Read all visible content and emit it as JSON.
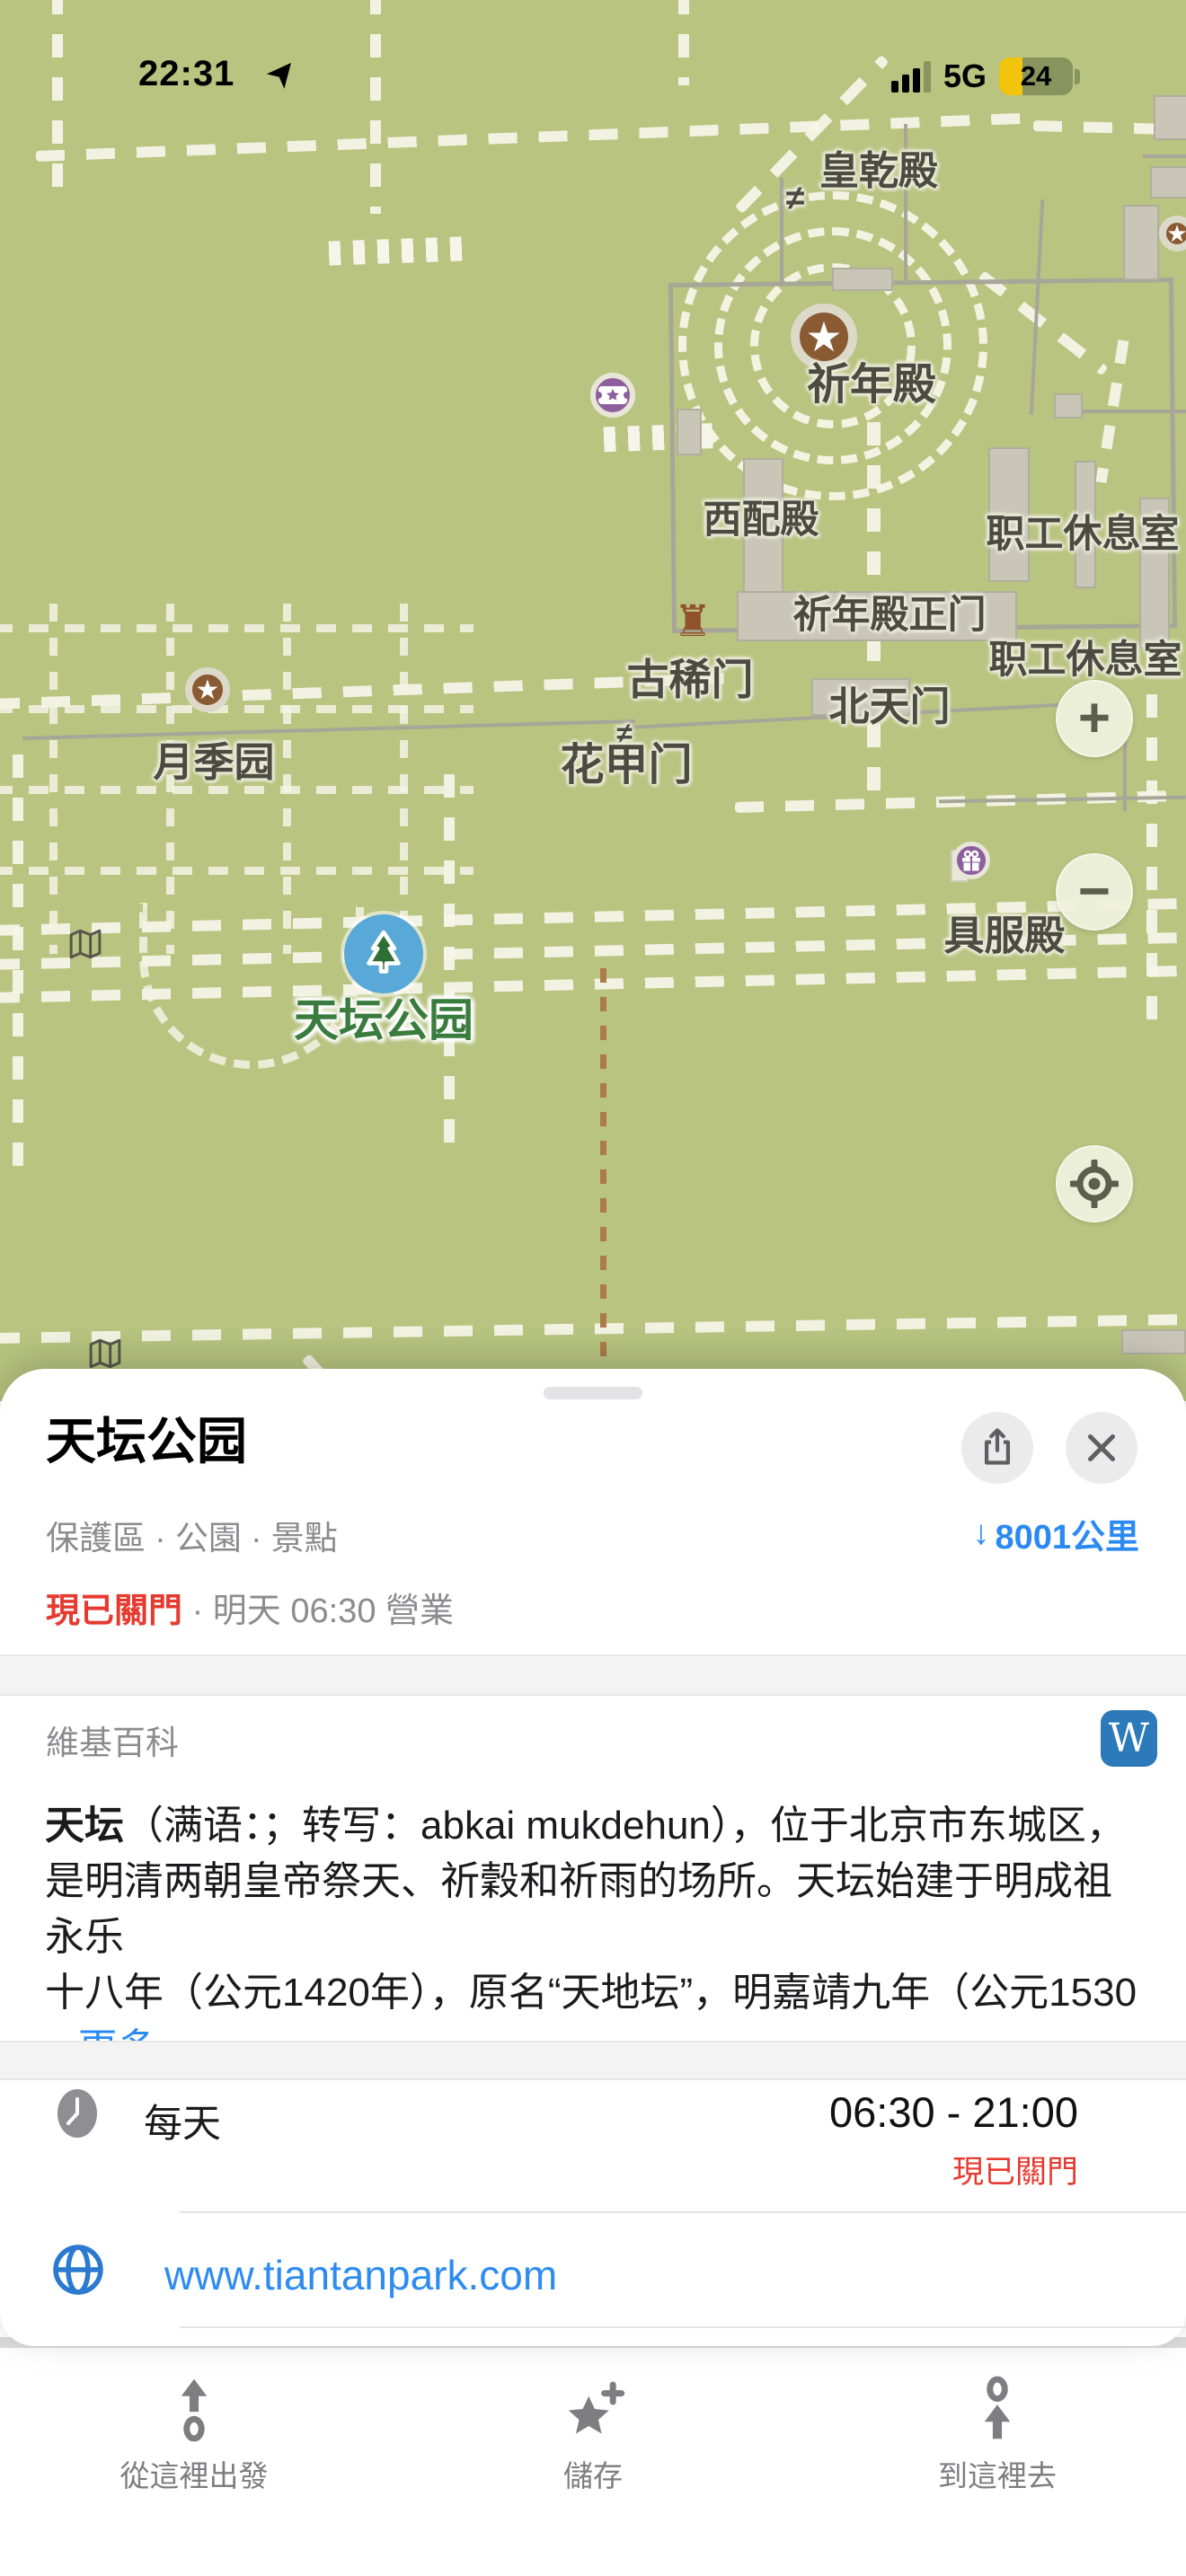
{
  "status_bar": {
    "time": "22:31",
    "network": "5G",
    "battery": "24"
  },
  "icons": {
    "star": "★",
    "rook": "♜",
    "gate": "≠",
    "plus": "+",
    "minus": "−",
    "down_arrow": "↓",
    "wikipedia_w": "W"
  },
  "map": {
    "labels": [
      {
        "text": "皇乾殿"
      },
      {
        "text": "祈年殿"
      },
      {
        "text": "西配殿"
      },
      {
        "text": "职工休息室"
      },
      {
        "text": "祈年殿正门"
      },
      {
        "text": "职工休息室"
      },
      {
        "text": "北天门"
      },
      {
        "text": "古稀门"
      },
      {
        "text": "花甲门"
      },
      {
        "text": "月季园"
      },
      {
        "text": "具服殿"
      }
    ],
    "park_label": "天坛公园"
  },
  "sheet": {
    "title": "天坛公园",
    "category": "保護區 · 公園 · 景點",
    "distance": "8001公里",
    "open_status": "現已關門",
    "separator": "·",
    "open_detail": "明天 06:30 營業",
    "wiki": {
      "header": "維基百科",
      "line1_bold": "天坛",
      "line1_rest": "（满语：；转写：abkai mukdehun），位于北京市东城区，",
      "line2": "是明清两朝皇帝祭天、祈穀和祈雨的场所。天坛始建于明成祖永乐",
      "line3": "十八年（公元1420年），原名“天地坛”，明嘉靖九年（公元1530",
      "more": "...更多"
    },
    "hours": {
      "label": "每天",
      "time": "06:30 - 21:00",
      "status": "現已關門"
    },
    "website": "www.tiantanpark.com"
  },
  "toolbar": {
    "from_here": "從這裡出發",
    "save": "儲存",
    "to_here": "到這裡去"
  }
}
